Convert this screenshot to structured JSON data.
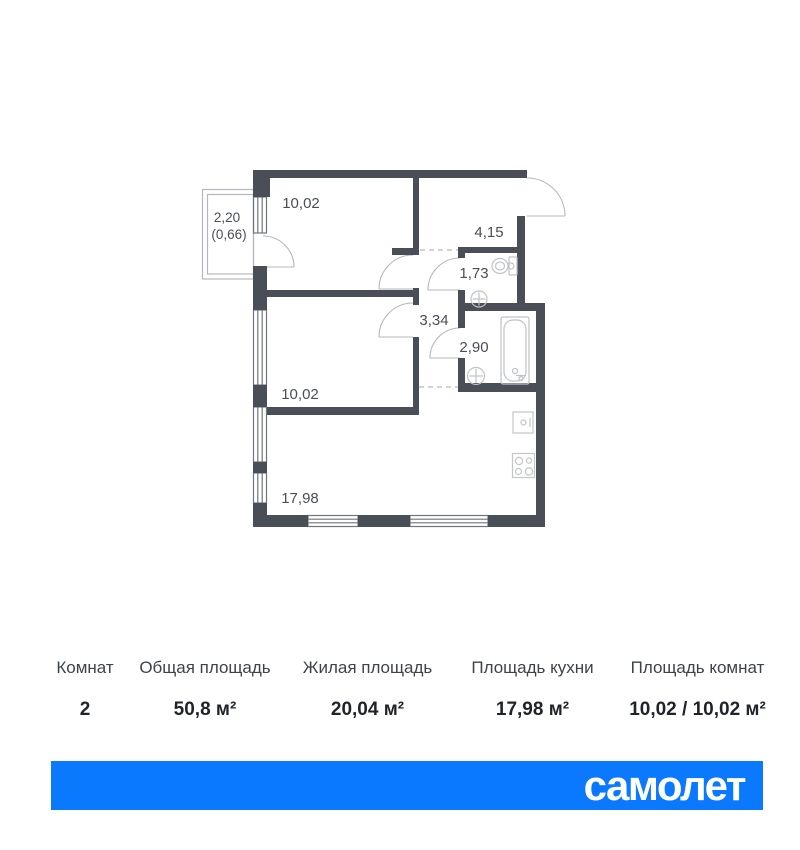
{
  "plan": {
    "balcony": {
      "area_total": "2,20",
      "area_counted": "(0,66)"
    },
    "rooms": [
      {
        "id": "bedroom-top",
        "label": "10,02"
      },
      {
        "id": "hallway",
        "label": "4,15"
      },
      {
        "id": "wc",
        "label": "1,73"
      },
      {
        "id": "corridor",
        "label": "3,34"
      },
      {
        "id": "bathroom",
        "label": "2,90"
      },
      {
        "id": "bedroom-middle",
        "label": "10,02"
      },
      {
        "id": "kitchen-living",
        "label": "17,98"
      }
    ],
    "wall_color": "#4a4e56",
    "line_color": "#b4b7bc"
  },
  "summary": {
    "columns": [
      {
        "label": "Комнат",
        "value": "2"
      },
      {
        "label": "Общая площадь",
        "value": "50,8 м²"
      },
      {
        "label": "Жилая площадь",
        "value": "20,04 м²"
      },
      {
        "label": "Площадь кухни",
        "value": "17,98 м²"
      },
      {
        "label": "Площадь комнат",
        "value": "10,02 / 10,02 м²"
      }
    ]
  },
  "brand": {
    "logo_text": "самолет",
    "banner_color": "#0b79fe"
  }
}
